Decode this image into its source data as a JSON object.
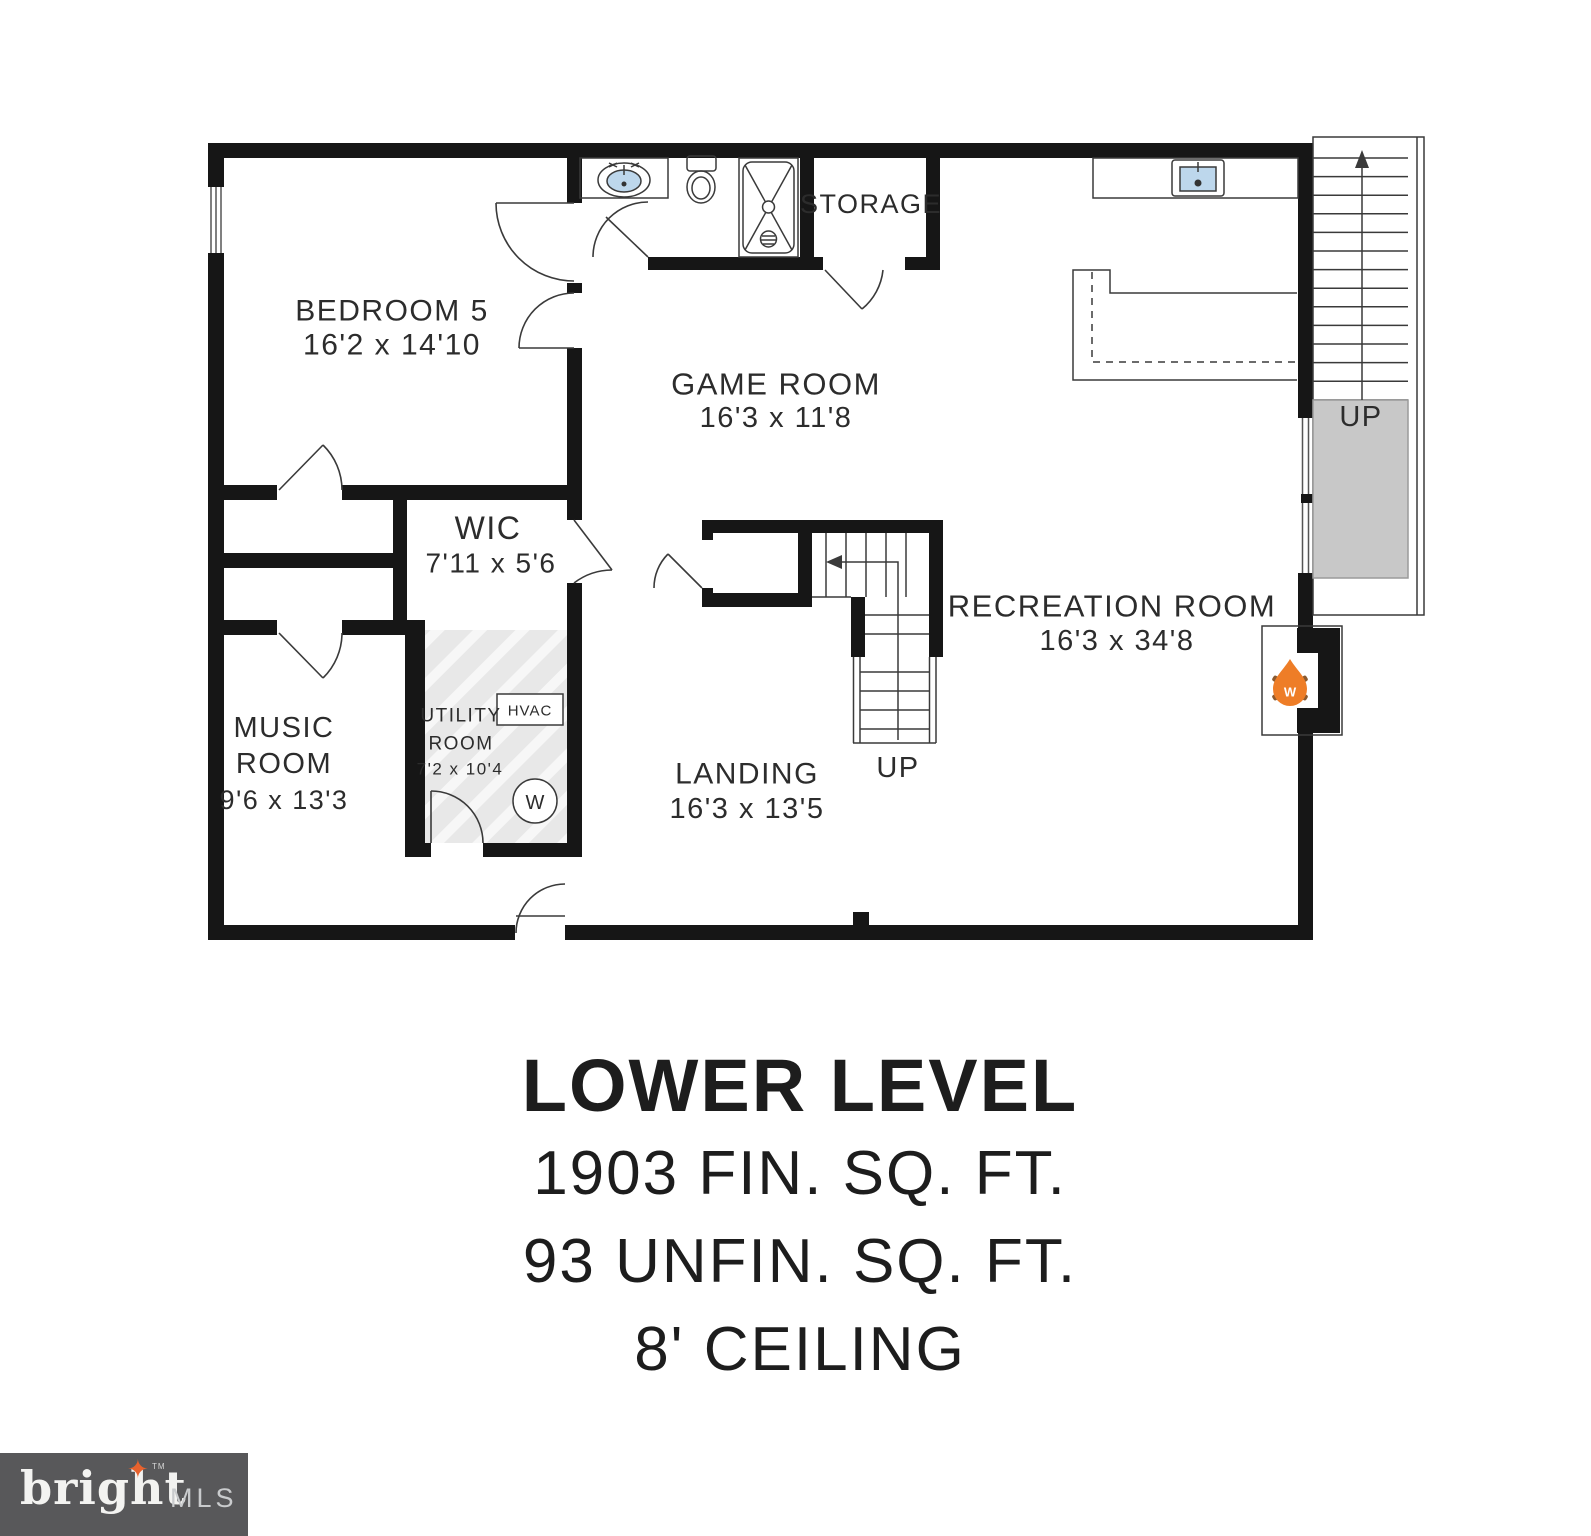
{
  "floorplan": {
    "rooms": {
      "bedroom5": {
        "name": "BEDROOM 5",
        "dims": "16'2 x 14'10"
      },
      "game_room": {
        "name": "GAME ROOM",
        "dims": "16'3 x 11'8"
      },
      "wic": {
        "name": "WIC",
        "dims": "7'11 x 5'6"
      },
      "music_room": {
        "name_line1": "MUSIC",
        "name_line2": "ROOM",
        "dims": "9'6 x 13'3"
      },
      "utility_room": {
        "name_line1": "UTILITY",
        "name_line2": "ROOM",
        "dims": "7'2 x 10'4"
      },
      "landing": {
        "name": "LANDING",
        "dims": "16'3 x 13'5"
      },
      "recreation_room": {
        "name": "RECREATION ROOM",
        "dims": "16'3 x 34'8"
      },
      "storage": {
        "name": "STORAGE"
      }
    },
    "stairs": {
      "up_right": "UP",
      "up_center": "UP"
    },
    "equipment": {
      "hvac": "HVAC",
      "washer": "W",
      "fireplace": "W"
    },
    "icons": [
      "sink-icon",
      "toilet-icon",
      "shower-icon",
      "bar-sink-icon",
      "washer-icon",
      "hvac-unit-icon",
      "fireplace-icon",
      "stairs-up-arrow-icon",
      "window-icon",
      "door-arc-icon"
    ],
    "colors": {
      "wall": "#161616",
      "line": "#333333",
      "sink_fill": "#bdd7ec",
      "hatch_bg": "#e8e8e8",
      "stair_landing_gray": "#c8c8c8",
      "fireplace_orange": "#ee7d27",
      "log_brown": "#8a5a30"
    }
  },
  "title_block": {
    "line1": "LOWER LEVEL",
    "line2": "1903 FIN. SQ. FT.",
    "line3": "93 UNFIN. SQ. FT.",
    "line4": "8' CEILING"
  },
  "footer_logo": {
    "brand": "bright",
    "tm": "TM",
    "suffix": "MLS"
  }
}
